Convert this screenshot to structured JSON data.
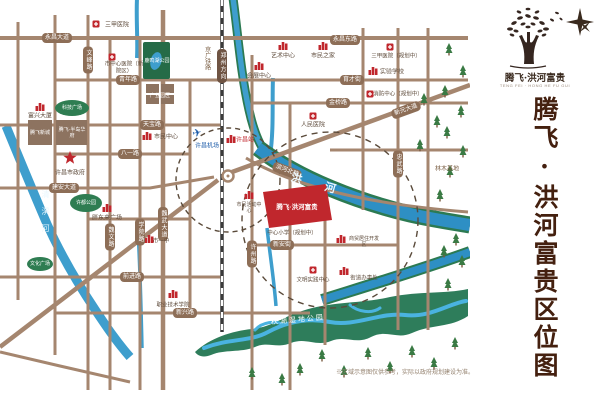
{
  "brand": {
    "name": "腾飞·洪河富贵",
    "tagline": "TENG FEI · HONG HE FU GUI"
  },
  "sidebar": {
    "title": "腾飞·洪河富贵区位图"
  },
  "footnote": "※区域示意图仅供参考，实际以政府规划建设为准。",
  "map": {
    "roads": {
      "yongchang_dadao": "永昌大道",
      "yongchang_donglu": "永昌东路",
      "qingnian": "青年路",
      "yucai": "育才街",
      "jinqiao": "金桥路",
      "tianbao": "天宝路",
      "bayi": "八一路",
      "jianan": "建安大道",
      "xinyuan": "新元大道",
      "binhe": "滨河北路",
      "xinan": "新安街",
      "qianjin": "前进路",
      "xinxing": "新兴路",
      "wenfeng": "文峰路",
      "weiwen": "魏文路",
      "xueyuan": "学院路",
      "weiwu": "魏武大道",
      "xuzhou": "许州路",
      "zhongwu": "忠武路"
    },
    "railway": {
      "name": "京广铁路",
      "direction": "郑州方向"
    },
    "rivers": {
      "qingyi": "清潩河",
      "honghe": "洪河"
    },
    "parks": {
      "luminghu": "鹿鸣湖公园",
      "xudu": "许都公园",
      "keji": "科技广场",
      "wenhua": "文化广场",
      "qiuhu": "秋湖湿地公园",
      "linmu": "林木基地"
    },
    "project": {
      "name": "腾飞·洪河富贵"
    },
    "pois": {
      "sanjia_top": "三甲医院",
      "xinyuan_hospital": "市中心医院（新院区）",
      "chanye": "产业园区",
      "fuxing": "富兴大厦",
      "tengfei_xincheng": "腾飞新城",
      "tengfei_bandao": "腾飞·半岛华府",
      "gov": "许昌市政府",
      "shimin_center": "市民中心",
      "pangdonglai": "胖东来广场",
      "yishu": "艺术中心",
      "shimin_zhijia": "市民之家",
      "sanjia_plan": "三甲医院（规划中）",
      "huizhan": "会展中心",
      "shiyan_school": "实验学校",
      "xiaofang": "消防中心（规划中）",
      "renmin_hospital": "人民医院",
      "airport": "许昌机场",
      "station": "许昌站",
      "huodong": "市民活动中心",
      "zhongxin_school": "中心小学（规划中）",
      "shangmao": "商贸居住开发区",
      "wenming": "文明实践中心",
      "jiedao": "街道办事处",
      "zhiyuan": "职业技术学院",
      "yizhong": "市一中"
    }
  }
}
